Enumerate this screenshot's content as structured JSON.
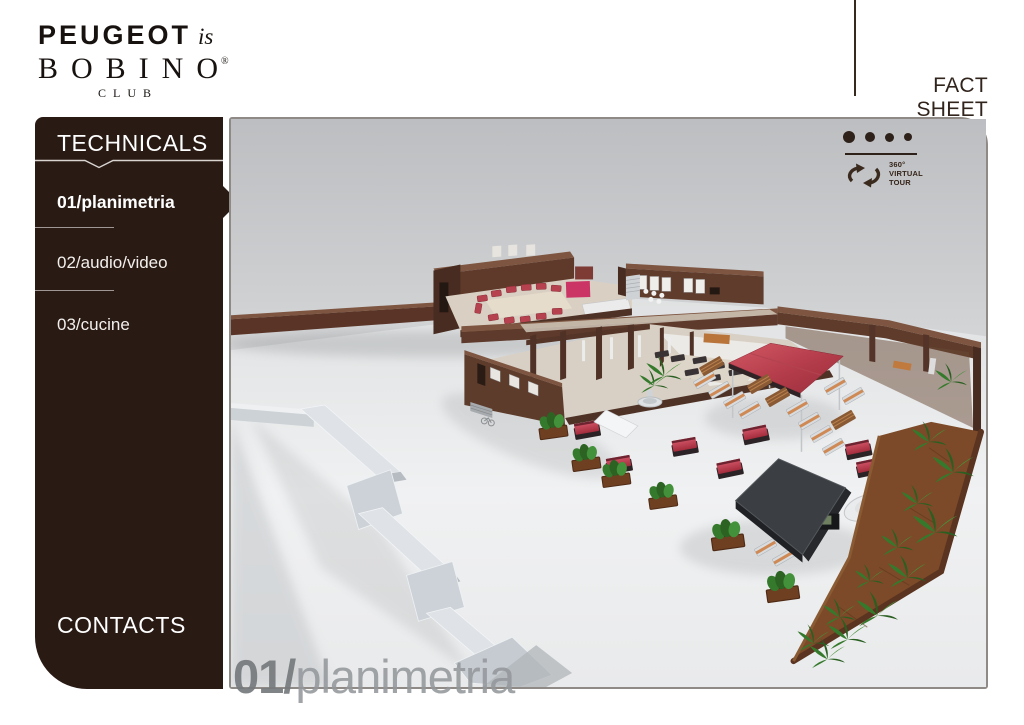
{
  "header": {
    "logo": {
      "brand": "PEUGEOT",
      "script": "is",
      "club": "BOBINO",
      "registered": "®",
      "club_sub": "CLUB"
    },
    "fact_sheet_label": "FACT SHEET"
  },
  "sidebar": {
    "title": "TECHNICALS",
    "items": [
      {
        "label": "01/planimetria",
        "active": true
      },
      {
        "label": "02/audio/video",
        "active": false
      },
      {
        "label": "03/cucine",
        "active": false
      }
    ],
    "contacts_label": "CONTACTS"
  },
  "viewer": {
    "pagination": {
      "total_dots": 4,
      "active_dot": 1
    },
    "virtual_tour": {
      "line1": "360°",
      "line2": "VIRTUAL",
      "line3": "TOUR"
    },
    "watermark": {
      "number": "01/",
      "name": "planimetria"
    },
    "scene_description": "3D isometric cutaway render of the Bobino Club: two brown buildings with red sofas, terrace with red daybeds, sun loungers, red canopy, dark stage, planters, diagonal garden bed and a glass zig-zag entrance sculpture"
  },
  "colors": {
    "sidebar_bg": "#291a14",
    "accent_red": "#b5424e",
    "canopy_red": "#b13a48",
    "wall_brown": "#5e3b2b",
    "garden_soil": "#7c4a28",
    "plant_green": "#357a2c",
    "text_dark": "#31241c"
  }
}
